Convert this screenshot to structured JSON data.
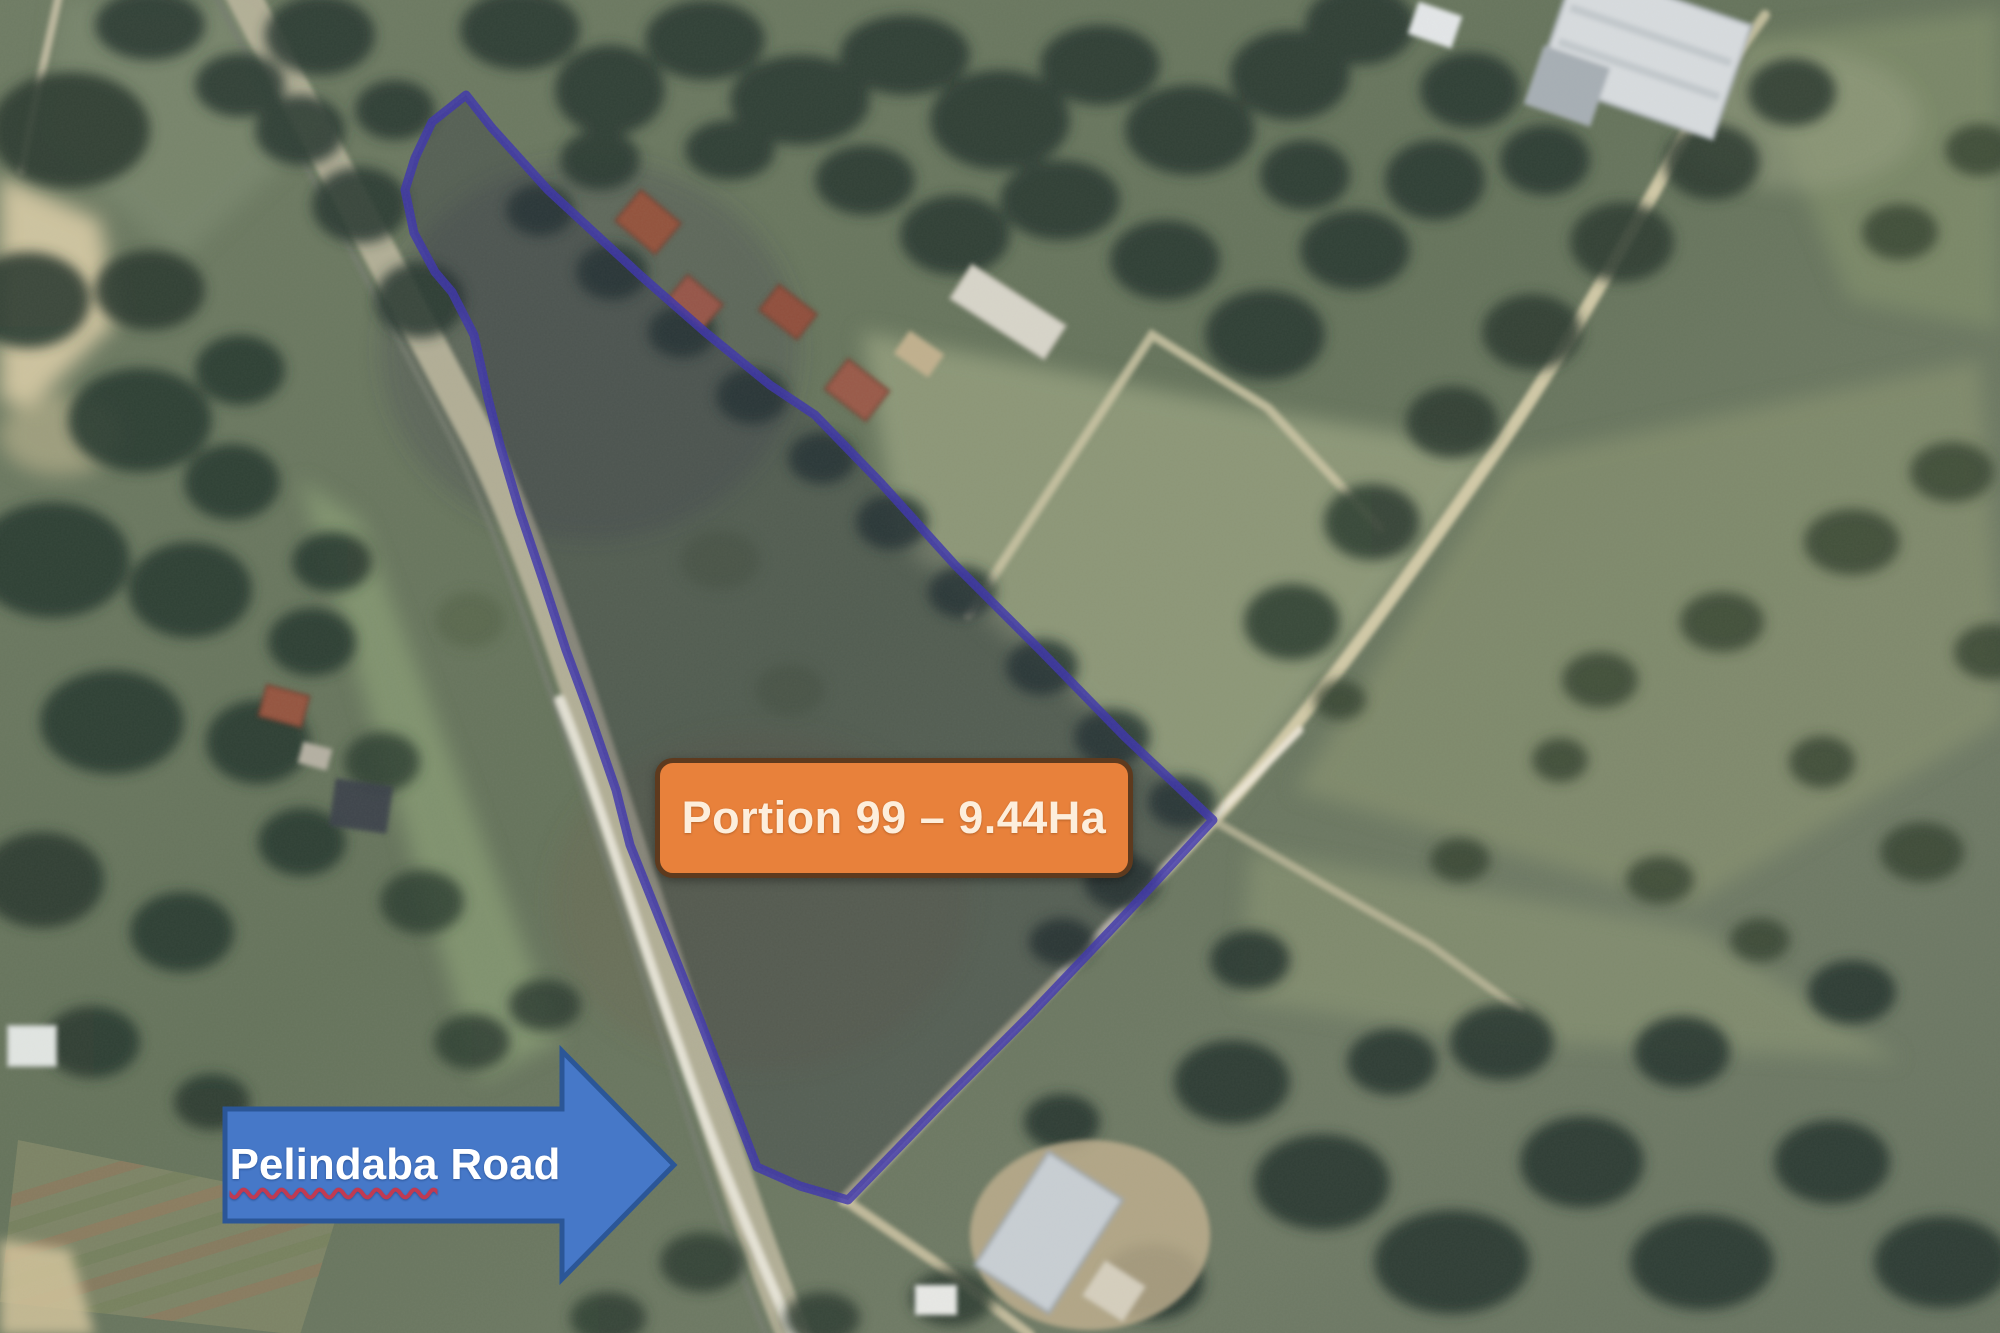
{
  "map": {
    "portion_label": "Portion 99 – 9.44Ha",
    "road_label_word": "Pelindaba",
    "road_label_rest": "Road"
  },
  "colors": {
    "portion_box_fill": "#E8813B",
    "portion_box_border": "#5E3A1E",
    "portion_box_text": "#FDEEDC",
    "arrow_fill": "#4678C8",
    "arrow_border": "#2B5697",
    "arrow_text": "#FFFFFF",
    "squiggle": "#C03A52",
    "boundary": "#3D35AD"
  }
}
